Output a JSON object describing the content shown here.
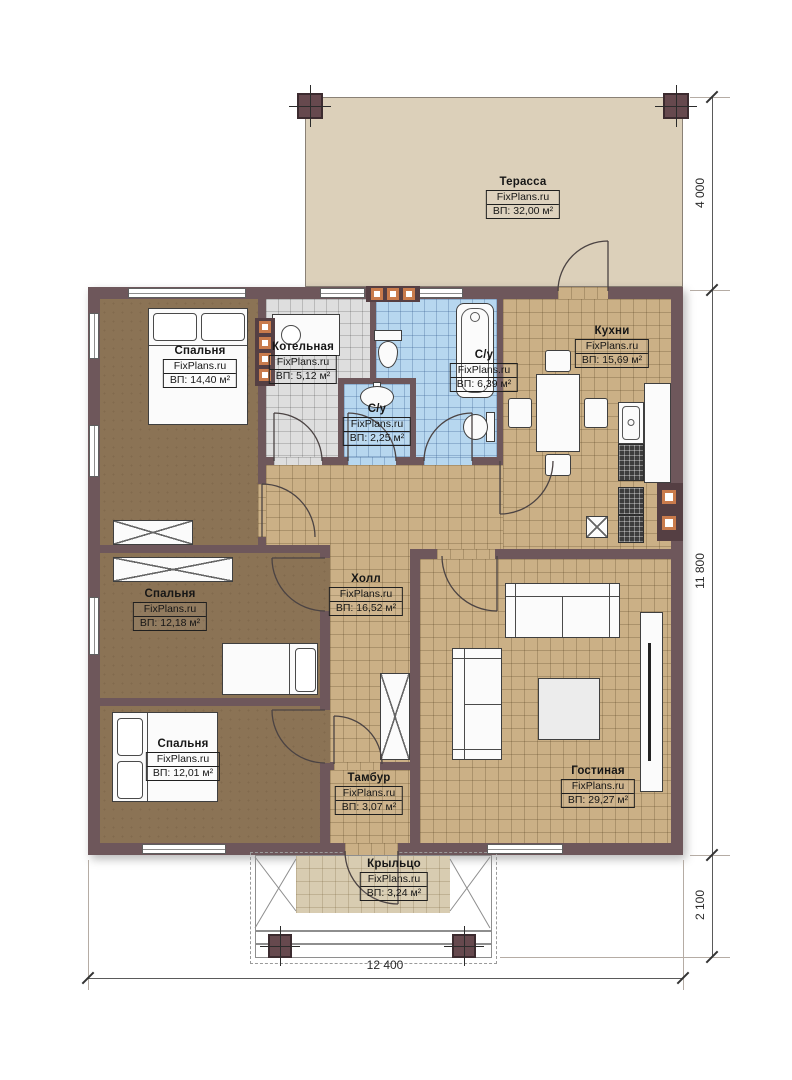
{
  "watermark": "FixPlans.ru",
  "rooms": [
    {
      "name": "Терасса",
      "area": "ВП: 32,00 м²"
    },
    {
      "name": "Кухни",
      "area": "ВП: 15,69 м²"
    },
    {
      "name": "Спальня",
      "area": "ВП: 14,40 м²"
    },
    {
      "name": "Котельная",
      "area": "ВП: 5,12 м²"
    },
    {
      "name": "С/у",
      "area": "ВП: 6,39 м²"
    },
    {
      "name": "С/у",
      "area": "ВП: 2,25 м²"
    },
    {
      "name": "Холл",
      "area": "ВП: 16,52 м²"
    },
    {
      "name": "Спальня",
      "area": "ВП: 12,18 м²"
    },
    {
      "name": "Спальня",
      "area": "ВП: 12,01 м²"
    },
    {
      "name": "Гостиная",
      "area": "ВП: 29,27 м²"
    },
    {
      "name": "Тамбур",
      "area": "ВП: 3,07 м²"
    },
    {
      "name": "Крыльцо",
      "area": "ВП: 3,24 м²"
    }
  ],
  "dimensions": {
    "right_top": "4 000",
    "right_middle": "11 800",
    "right_bottom": "2 100",
    "bottom_width": "12 400"
  },
  "colors": {
    "wall": "#6e575b",
    "bedroom_floor": "#8b7355",
    "tile_tan": "#cbb086",
    "tile_blue": "#b7d7ef",
    "tile_gray": "#dedede",
    "terrace": "#dcd0ba",
    "porch": "#d8ccb1",
    "vent_accent": "#c97b4c"
  }
}
